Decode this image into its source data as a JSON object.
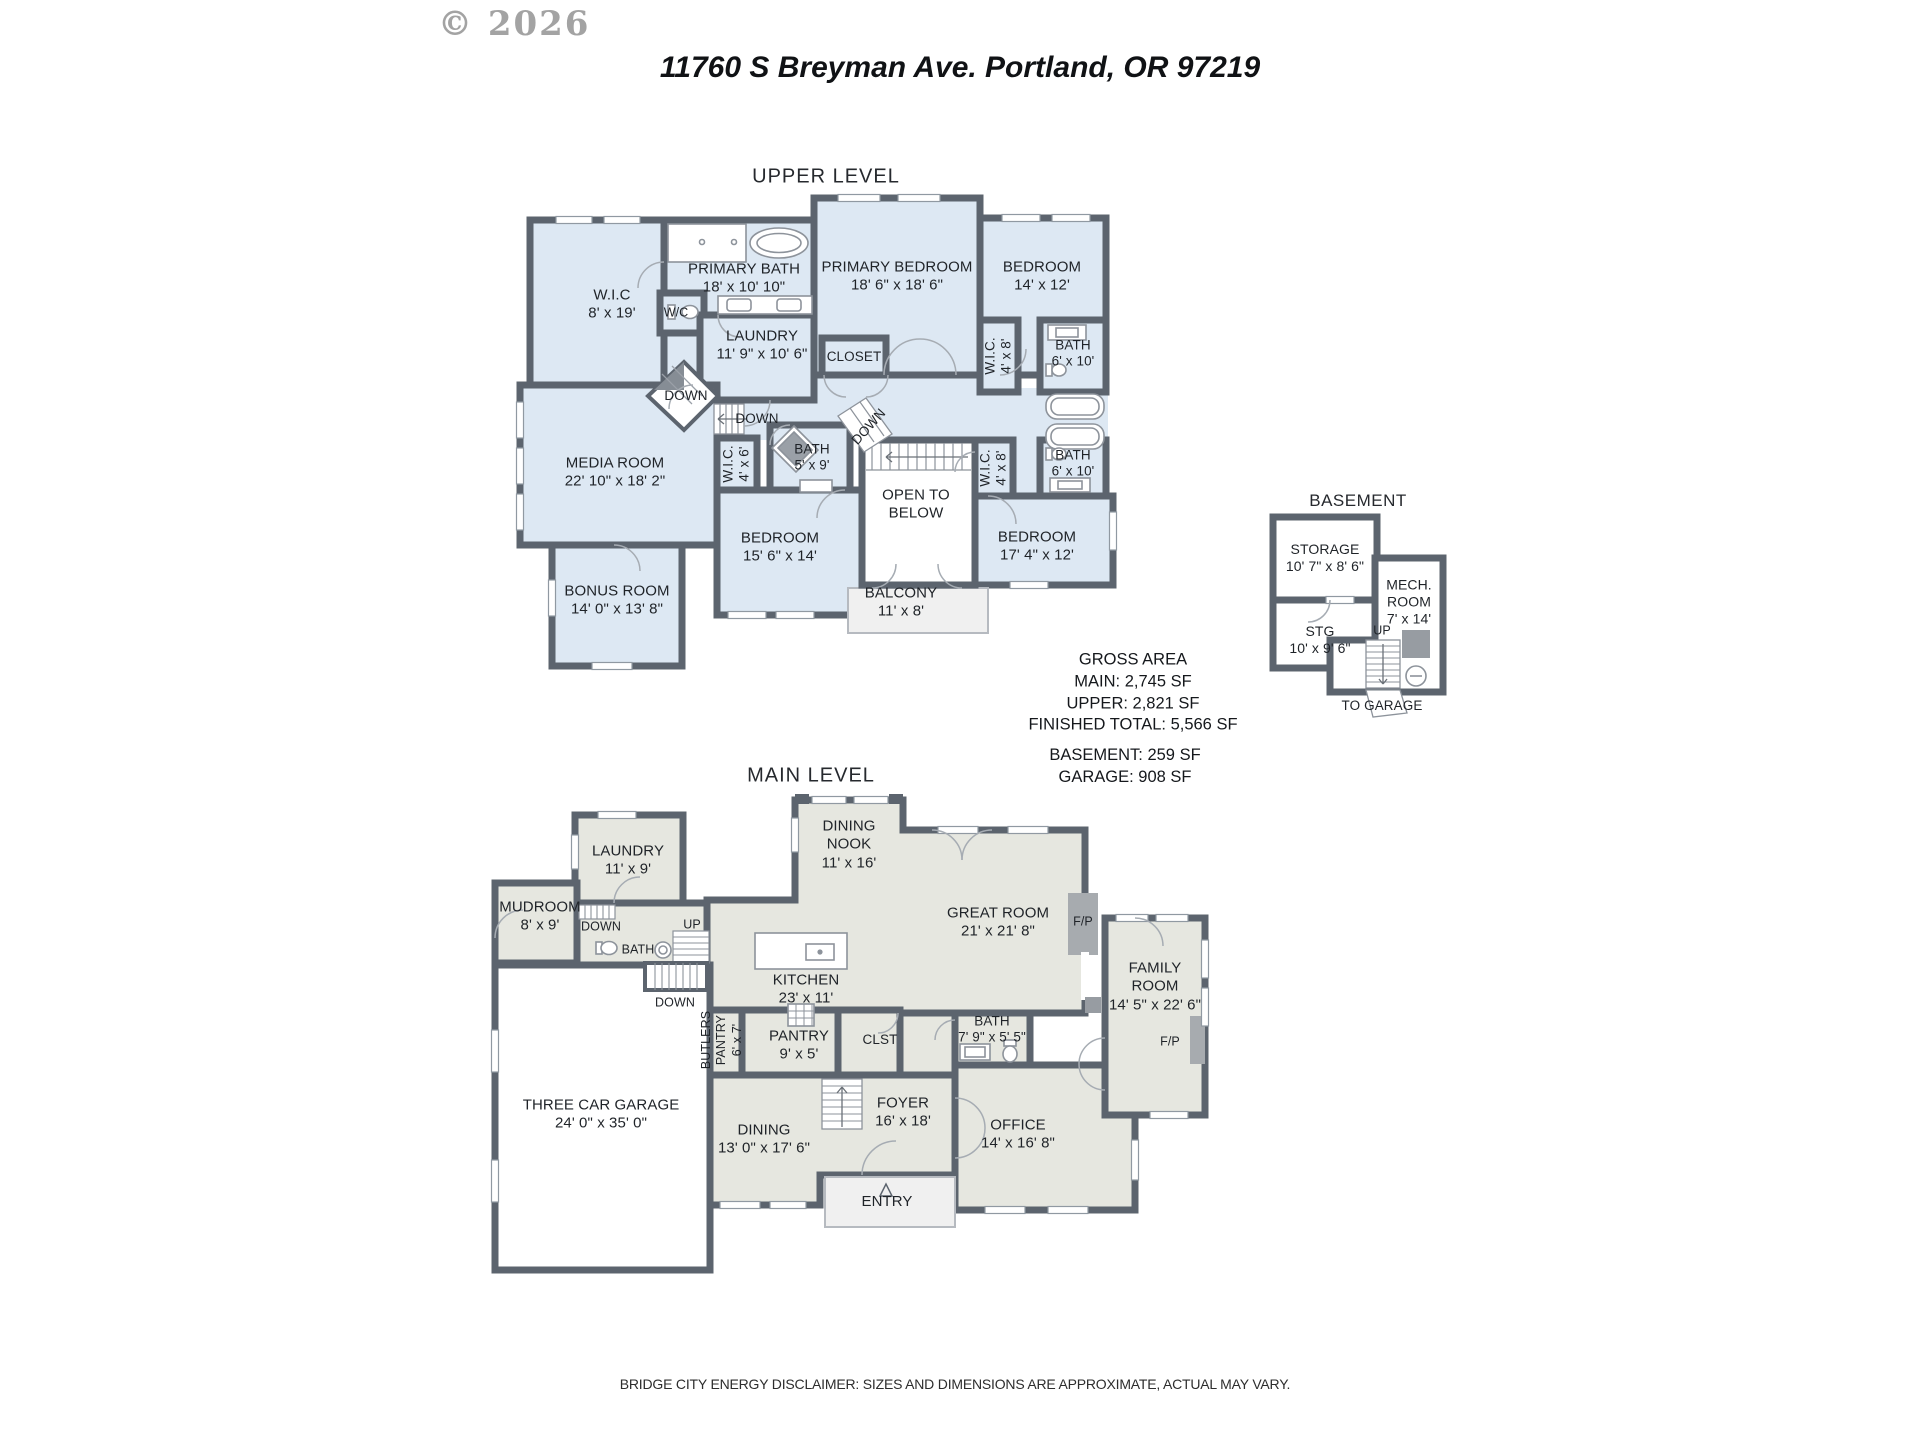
{
  "watermark": "© 2026",
  "title": "11760 S Breyman Ave. Portland, OR 97219",
  "colors": {
    "upper_fill": "#dde8f3",
    "main_fill": "#e6e7e0",
    "wall": "#5c646e",
    "outdoor": "#f0f0f0"
  },
  "upper": {
    "heading": "UPPER LEVEL",
    "rooms": {
      "wic": {
        "name": "W.I.C",
        "dims": "8' x 19'"
      },
      "primary_bath": {
        "name": "PRIMARY BATH",
        "dims": "18' x 10' 10\""
      },
      "wc": {
        "name": "W/C"
      },
      "primary_bedroom": {
        "name": "PRIMARY BEDROOM",
        "dims": "18' 6\" x 18' 6\""
      },
      "bedroom_ne": {
        "name": "BEDROOM",
        "dims": "14' x 12'"
      },
      "laundry": {
        "name": "LAUNDRY",
        "dims": "11' 9\" x 10' 6\""
      },
      "closet": {
        "name": "CLOSET"
      },
      "wic_ne": {
        "name": "W.I.C.",
        "dims": "4' x 8'"
      },
      "bath_ne": {
        "name": "BATH",
        "dims": "6' x 10'"
      },
      "media": {
        "name": "MEDIA ROOM",
        "dims": "22' 10\" x 18' 2\""
      },
      "wic_mid": {
        "name": "W.I.C.",
        "dims": "4' x 6'"
      },
      "bath_mid": {
        "name": "BATH",
        "dims": "5' x 9'"
      },
      "open_below": {
        "line1": "OPEN TO",
        "line2": "BELOW"
      },
      "wic_se": {
        "name": "W.I.C.",
        "dims": "4' x 8'"
      },
      "bath_se": {
        "name": "BATH",
        "dims": "6' x 10'"
      },
      "bedroom_s": {
        "name": "BEDROOM",
        "dims": "15' 6\" x 14'"
      },
      "bedroom_se": {
        "name": "BEDROOM",
        "dims": "17' 4\" x 12'"
      },
      "bonus": {
        "name": "BONUS ROOM",
        "dims": "14' 0\" x 13' 8\""
      },
      "balcony": {
        "name": "BALCONY",
        "dims": "11' x 8'"
      }
    },
    "stairs": {
      "down": "DOWN"
    }
  },
  "basement": {
    "heading": "BASEMENT",
    "rooms": {
      "storage": {
        "name": "STORAGE",
        "dims": "10' 7\" x 8' 6\""
      },
      "mech": {
        "line1": "MECH.",
        "line2": "ROOM",
        "dims": "7' x 14'"
      },
      "stg": {
        "name": "STG",
        "dims": "10' x 9' 6\""
      }
    },
    "up": "UP",
    "to_garage": "TO GARAGE"
  },
  "areas": {
    "title": "GROSS AREA",
    "main": "MAIN: 2,745 SF",
    "upper": "UPPER: 2,821 SF",
    "total": "FINISHED TOTAL: 5,566 SF",
    "basement": "BASEMENT: 259 SF",
    "garage": "GARAGE: 908 SF"
  },
  "main_level": {
    "heading": "MAIN LEVEL",
    "rooms": {
      "laundry": {
        "name": "LAUNDRY",
        "dims": "11' x 9'"
      },
      "mudroom": {
        "name": "MUDROOM",
        "dims": "8' x 9'"
      },
      "nook": {
        "line1": "DINING",
        "line2": "NOOK",
        "dims": "11' x 16'"
      },
      "great": {
        "name": "GREAT ROOM",
        "dims": "21' x 21' 8\""
      },
      "family": {
        "line1": "FAMILY",
        "line2": "ROOM",
        "dims": "14' 5\" x 22' 6\""
      },
      "kitchen": {
        "name": "KITCHEN",
        "dims": "23' x 11'"
      },
      "bath_hall": {
        "name": "BATH"
      },
      "bath": {
        "name": "BATH",
        "dims": "7' 9\" x 5' 5\""
      },
      "butlers": {
        "line1": "BUTLERS",
        "line2": "PANTRY",
        "dims": "6' x 7'"
      },
      "pantry": {
        "name": "PANTRY",
        "dims": "9' x 5'"
      },
      "clst": {
        "name": "CLST"
      },
      "foyer": {
        "name": "FOYER",
        "dims": "16' x 18'"
      },
      "dining": {
        "name": "DINING",
        "dims": "13' 0\" x 17' 6\""
      },
      "office": {
        "name": "OFFICE",
        "dims": "14' x 16' 8\""
      },
      "garage": {
        "name": "THREE CAR GARAGE",
        "dims": "24' 0\" x 35' 0\""
      },
      "entry": {
        "name": "ENTRY"
      }
    },
    "labels": {
      "up": "UP",
      "down": "DOWN",
      "fp": "F/P"
    }
  },
  "disclaimer": "BRIDGE CITY ENERGY DISCLAIMER: SIZES AND DIMENSIONS ARE APPROXIMATE, ACTUAL MAY VARY."
}
